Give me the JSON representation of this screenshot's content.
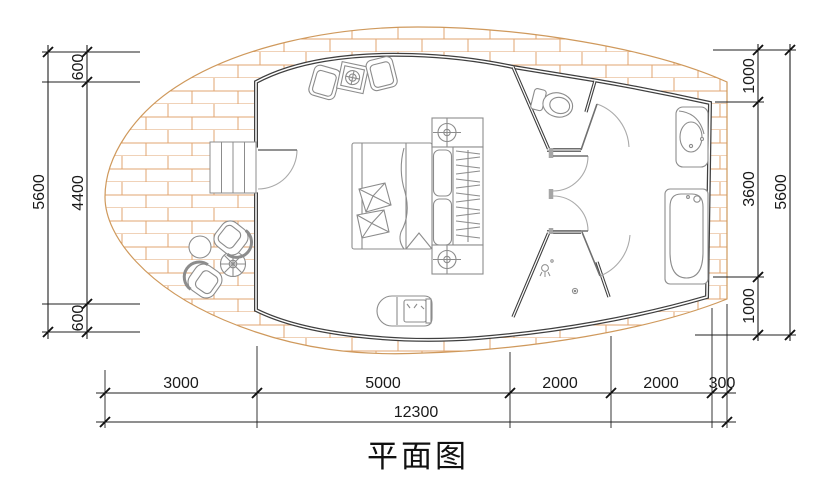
{
  "title": "平面图",
  "colors": {
    "wall": "#3f3f3f",
    "deck_brick": "#e2a670",
    "furniture_line": "#8c8c8c",
    "dimension_line": "#1f1f1f"
  },
  "dimensions": {
    "left": {
      "total": "5600",
      "segments": [
        "600",
        "4400",
        "600"
      ]
    },
    "right": {
      "total": "5600",
      "segments": [
        "1000",
        "3600",
        "1000"
      ]
    },
    "bottom": {
      "total": "12300",
      "segments": [
        "3000",
        "5000",
        "2000",
        "2000",
        "300"
      ]
    }
  }
}
